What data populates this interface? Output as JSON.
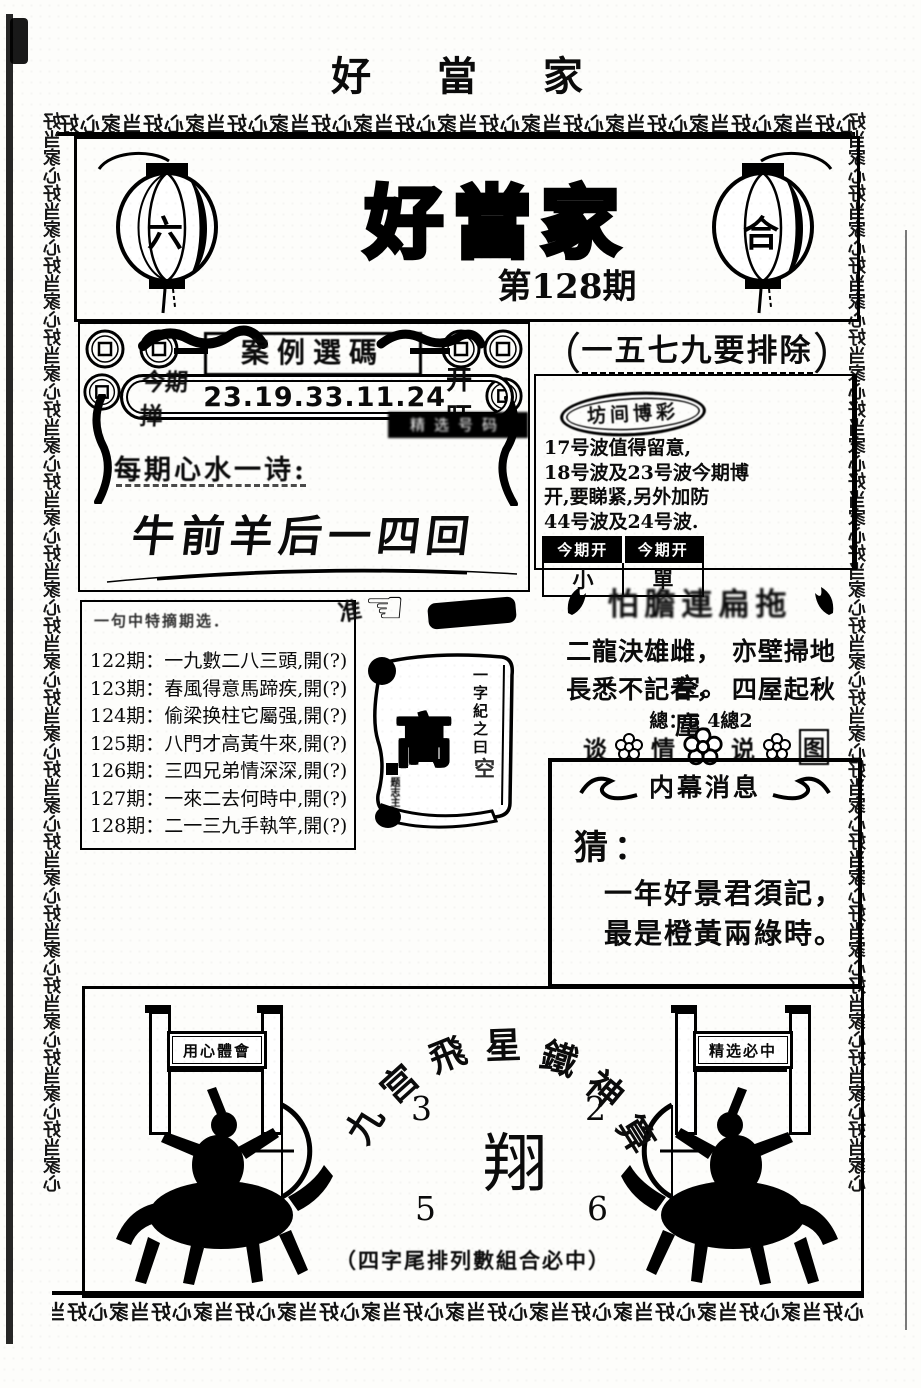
{
  "page": {
    "top_title": "好 當 家",
    "border_pattern_h": "心好当家心好当家心好当家心好当家心好当家心好当家心好当家心好当家心好当家心好当家心好当家心好当家",
    "border_pattern_v": "好当家心好当家心好当家心好当家心好当家心好当家心好当家心好当家心好当家心好当家心好当家心好当家心好当家心好当家心好当家心"
  },
  "header": {
    "title": "好當家",
    "issue": "第128期",
    "lantern_left_char": "六",
    "lantern_right_char": "合"
  },
  "case_section": {
    "title": "案例選碼",
    "pill_label": "今期掸",
    "pill_numbers": "23.19.33.11.24",
    "pill_suffix": "开旺",
    "black_box": "精选号码",
    "poem_label": "每期心水一诗:",
    "poem": "牛前羊后一四回"
  },
  "exclude_section": {
    "bracket_left": "（",
    "bracket_right": "）",
    "title": "一五七九要排除",
    "oval_label": "坊间博彩",
    "lines": [
      "17号波值得留意,",
      "18号波及23号波今期博",
      "开,要睇紧,另外加防",
      "44号波及24号波."
    ],
    "table_header_1": "今期开",
    "table_header_2": "今期开",
    "table_cell_1": "小",
    "table_cell_2": "單"
  },
  "history_box": {
    "title": "一句中特摘期选．",
    "items": [
      "122期：一九數二八三頭,開(?)",
      "123期：春風得意馬蹄疾,開(?)",
      "124期：偷梁换柱它屬强,開(?)",
      "125期：八門才高黃牛來,開(?)",
      "126期：三四兄弟情深深,開(?)",
      "127期：一來二去何時中,開(?)",
      "128期：二一三九手執竿,開(?)"
    ]
  },
  "pointer": {
    "label": "准",
    "hand_glyph": "☜"
  },
  "scroll": {
    "phrase_vertical": "一字紀之曰",
    "big_char": "高",
    "side_char": "空",
    "seal_text": "题志主"
  },
  "tips_section": {
    "banner": "怕膽連扁拖",
    "poem_line1": "二龍決雄雌， 亦壁掃地空。",
    "poem_line2": "長悉不記春， 四屋起秋塵。",
    "note": "總：5 4總2",
    "flower_chars": [
      "谈",
      "情",
      "说",
      "图"
    ]
  },
  "insider_box": {
    "title": "内幕消息",
    "guess_label": "猜：",
    "line1": "一年好景君須記，",
    "line2": "最是橙黃兩綠時。"
  },
  "bottom_section": {
    "arc_chars": [
      "九",
      "宫",
      "飛",
      "星",
      "鐵",
      "神",
      "算"
    ],
    "num_top_left": "3",
    "num_top_right": "2",
    "center_char": "翔",
    "num_bottom_left": "5",
    "num_bottom_right": "6",
    "left_banner": "用心體會",
    "right_banner": "精选必中",
    "footer": "（四字尾排列數組合必中）"
  }
}
